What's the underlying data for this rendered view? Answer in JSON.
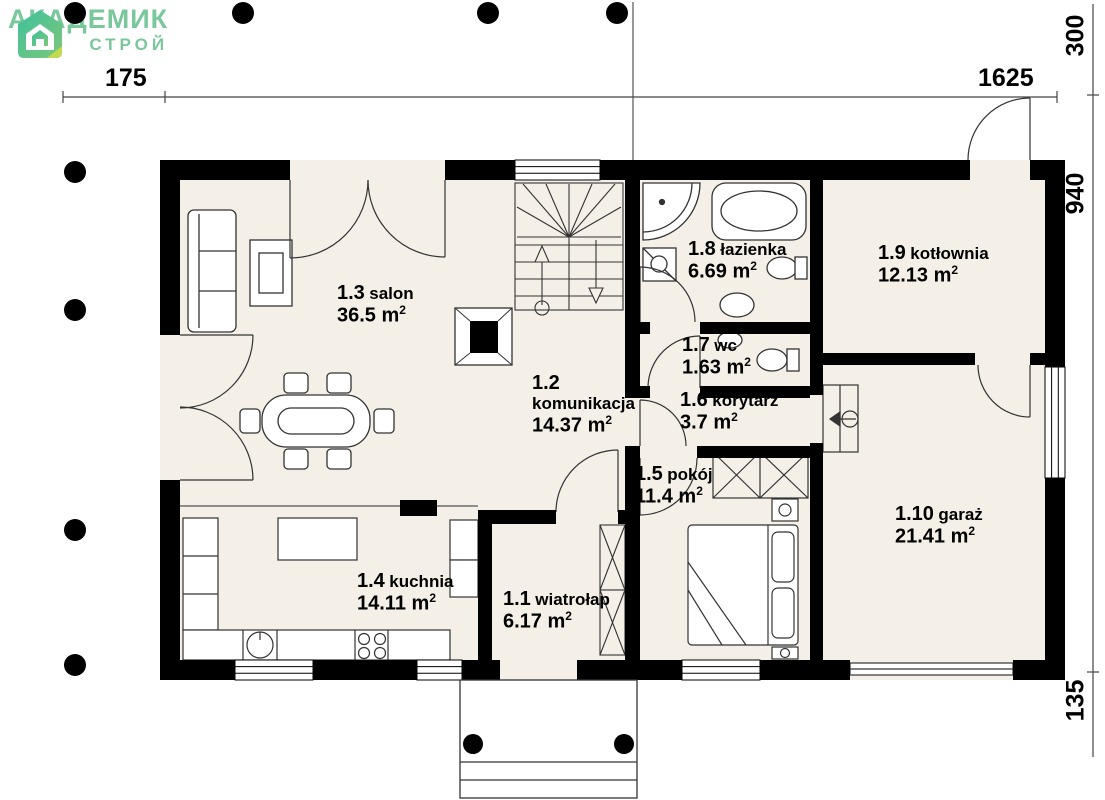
{
  "logo": {
    "brand_line1": "АКАДЕМИК",
    "brand_line2": "СТРОЙ"
  },
  "unit": {
    "base": "m",
    "exp": "2"
  },
  "dimensions": {
    "top": [
      "175",
      "1625"
    ],
    "right": [
      "300",
      "940",
      "135"
    ]
  },
  "rooms": [
    {
      "id": "1.1",
      "name": "wiatrołap",
      "area": "6.17"
    },
    {
      "id": "1.2",
      "name": "komunikacja",
      "area": "14.37"
    },
    {
      "id": "1.3",
      "name": "salon",
      "area": "36.5"
    },
    {
      "id": "1.4",
      "name": "kuchnia",
      "area": "14.11"
    },
    {
      "id": "1.5",
      "name": "pokój",
      "area": "11.4"
    },
    {
      "id": "1.6",
      "name": "korytarz",
      "area": "3.7"
    },
    {
      "id": "1.7",
      "name": "wc",
      "area": "1.63"
    },
    {
      "id": "1.8",
      "name": "łazienka",
      "area": "6.69"
    },
    {
      "id": "1.9",
      "name": "kotłownia",
      "area": "12.13"
    },
    {
      "id": "1.10",
      "name": "garaż",
      "area": "21.41"
    }
  ],
  "colors": {
    "brand_green": "#79c79a",
    "floor_fill": "#f4efe7",
    "wall": "#000000"
  }
}
